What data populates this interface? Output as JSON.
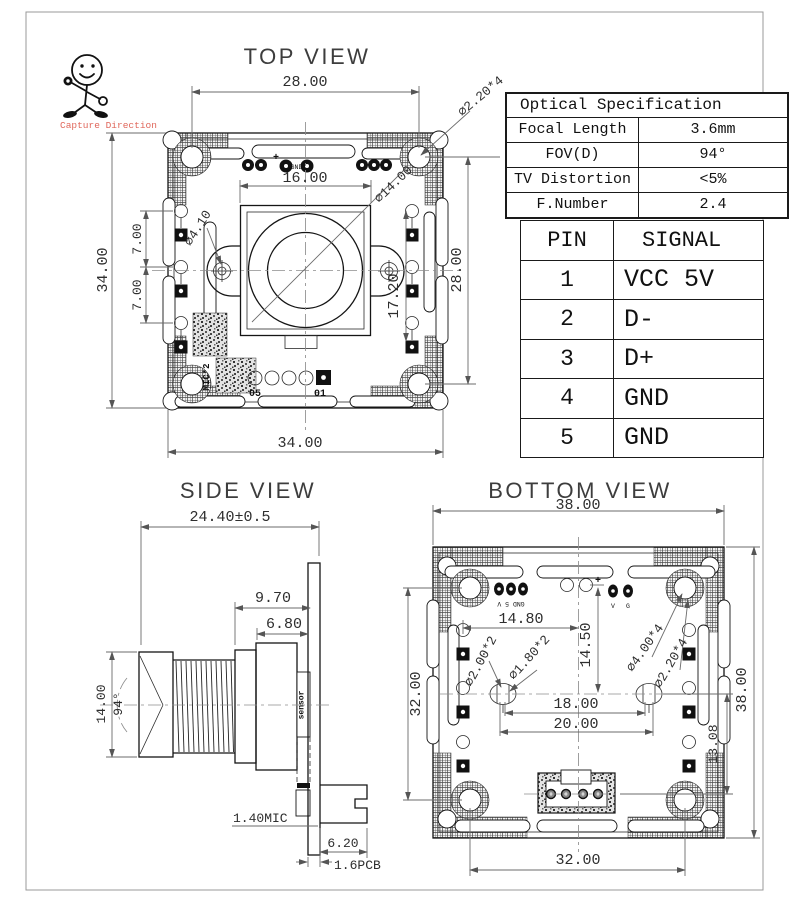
{
  "figure": {
    "capture_direction": "Capture Direction",
    "accent_red": "#e0685c",
    "frame_color": "#999999"
  },
  "top_view": {
    "title": "TOP VIEW",
    "dim_width_holes": "28.00",
    "callout_corner_hole": "⌀2.20*4",
    "dim_lens_width": "16.00",
    "callout_lens_dia": "⌀14.00",
    "callout_ear_hole": "⌀4.10",
    "dim_board_height": "34.00",
    "dim_pitch_upper": "7.00",
    "dim_pitch_lower": "7.00",
    "dim_pad_span": "17.20",
    "dim_height_holes": "28.00",
    "dim_board_width": "34.00",
    "pad_label_first": "05",
    "pad_label_last": "01",
    "mic_label": "MIC*2",
    "plus_mark": "+",
    "silk_center": "GND"
  },
  "side_view": {
    "title": "SIDE VIEW",
    "dim_total_length": "24.40±0.5",
    "dim_holder_length": "9.70",
    "dim_mount_length": "6.80",
    "dim_lens_dia": "14.00",
    "dim_fov_angle": "94°",
    "label_mic": "1.40MIC",
    "dim_connector": "6.20",
    "label_pcb": "1.6PCB",
    "label_sensor": "sensor"
  },
  "bottom_view": {
    "title": "BOTTOM  VIEW",
    "dim_total_width": "38.00",
    "dim_boss_offset": "14.80",
    "dim_boss_vertical": "14.50",
    "callout_boss_hole": "⌀2.00*2",
    "callout_boss_hole2": "⌀1.80*2",
    "callout_corner_hole": "⌀4.00*4",
    "callout_corner_hole2": "⌀2.20*4",
    "dim_boss_span": "18.00",
    "dim_boss_span_outer": "20.00",
    "dim_connector_offset": "13.08",
    "dim_holes_vertical": "32.00",
    "dim_total_height": "38.00",
    "dim_holes_horizontal": "32.00",
    "plus_mark": "+",
    "silk_left": "GND 5 V",
    "silk_v": "V",
    "silk_g": "G"
  },
  "optical_spec": {
    "title": "Optical Specification",
    "rows": [
      {
        "label": "Focal Length",
        "value": "3.6mm"
      },
      {
        "label": "FOV(D)",
        "value": "94°"
      },
      {
        "label": "TV Distortion",
        "value": "<5%"
      },
      {
        "label": "F.Number",
        "value": "2.4"
      }
    ]
  },
  "pin_table": {
    "header_pin": "PIN",
    "header_signal": "SIGNAL",
    "rows": [
      {
        "pin": "1",
        "signal": "VCC 5V"
      },
      {
        "pin": "2",
        "signal": "D-"
      },
      {
        "pin": "3",
        "signal": "D+"
      },
      {
        "pin": "4",
        "signal": "GND"
      },
      {
        "pin": "5",
        "signal": "GND"
      }
    ]
  }
}
